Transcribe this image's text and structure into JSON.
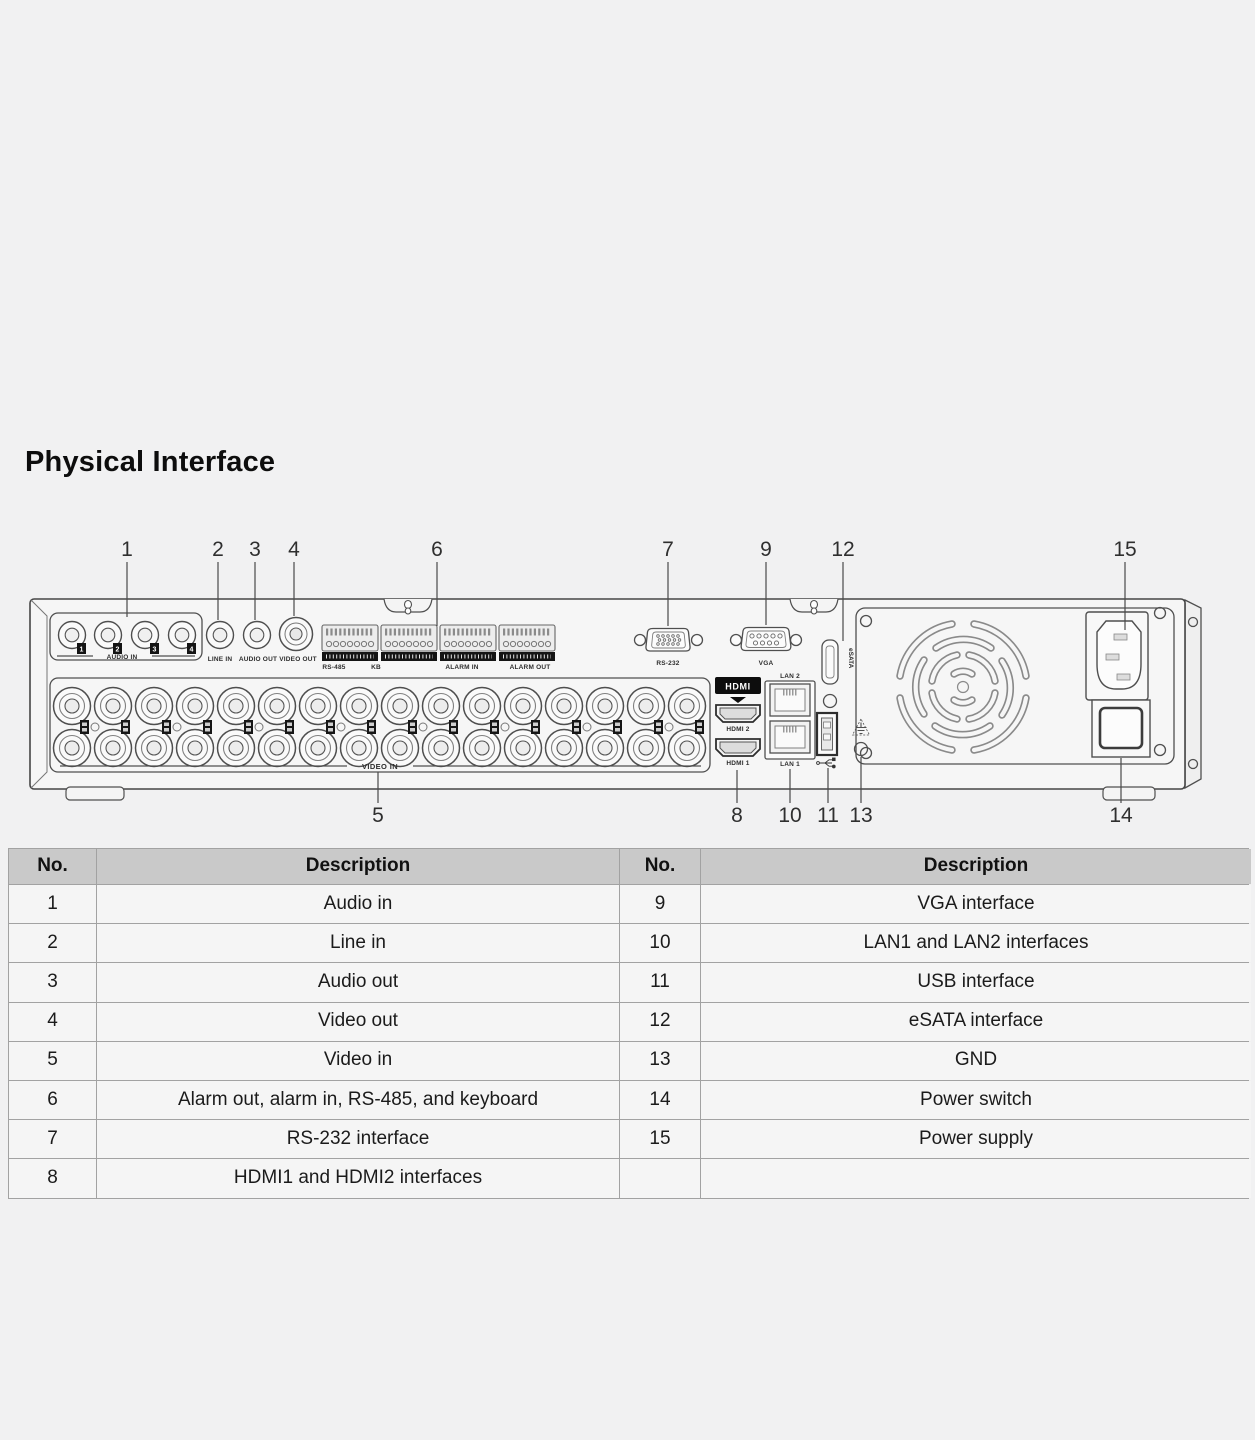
{
  "title": "Physical Interface",
  "diagram": {
    "callouts": {
      "c1": "1",
      "c2": "2",
      "c3": "3",
      "c4": "4",
      "c5": "5",
      "c6": "6",
      "c7": "7",
      "c8": "8",
      "c9": "9",
      "c10": "10",
      "c11": "11",
      "c12": "12",
      "c13": "13",
      "c14": "14",
      "c15": "15"
    },
    "labels": {
      "audio_in": "AUDIO IN",
      "line_in": "LINE IN",
      "audio_out": "AUDIO OUT",
      "video_out": "VIDEO OUT",
      "rs485": "RS-485",
      "kb": "KB",
      "alarm_in": "ALARM IN",
      "alarm_out": "ALARM OUT",
      "video_in": "VIDEO IN",
      "rs232": "RS-232",
      "vga": "VGA",
      "esata": "eSATA",
      "hdmi_logo": "HDMI",
      "hdmi2": "HDMI 2",
      "hdmi1": "HDMI 1",
      "lan2": "LAN 2",
      "lan1": "LAN 1"
    },
    "audio_channels": [
      "1",
      "2",
      "3",
      "4"
    ],
    "icons": {
      "usb_symbol": "usb-trident",
      "ground_symbol": "protective-earth"
    }
  },
  "table": {
    "header_no": "No.",
    "header_description": "Description",
    "left_rows": [
      {
        "no": "1",
        "desc": "Audio in"
      },
      {
        "no": "2",
        "desc": "Line in"
      },
      {
        "no": "3",
        "desc": "Audio out"
      },
      {
        "no": "4",
        "desc": "Video out"
      },
      {
        "no": "5",
        "desc": "Video in"
      },
      {
        "no": "6",
        "desc": "Alarm out, alarm in, RS-485, and keyboard"
      },
      {
        "no": "7",
        "desc": "RS-232 interface"
      },
      {
        "no": "8",
        "desc": "HDMI1 and HDMI2 interfaces"
      }
    ],
    "right_rows": [
      {
        "no": "9",
        "desc": "VGA interface"
      },
      {
        "no": "10",
        "desc": "LAN1 and LAN2 interfaces"
      },
      {
        "no": "11",
        "desc": "USB interface"
      },
      {
        "no": "12",
        "desc": "eSATA interface"
      },
      {
        "no": "13",
        "desc": "GND"
      },
      {
        "no": "14",
        "desc": "Power switch"
      },
      {
        "no": "15",
        "desc": "Power supply"
      },
      {
        "no": "",
        "desc": ""
      }
    ]
  },
  "colors": {
    "background": "#f1f1f2",
    "table_header_bg": "#c9c9c9",
    "table_cell_bg": "#f5f5f5",
    "line": "#4f4f4f",
    "badge": "#141414"
  }
}
